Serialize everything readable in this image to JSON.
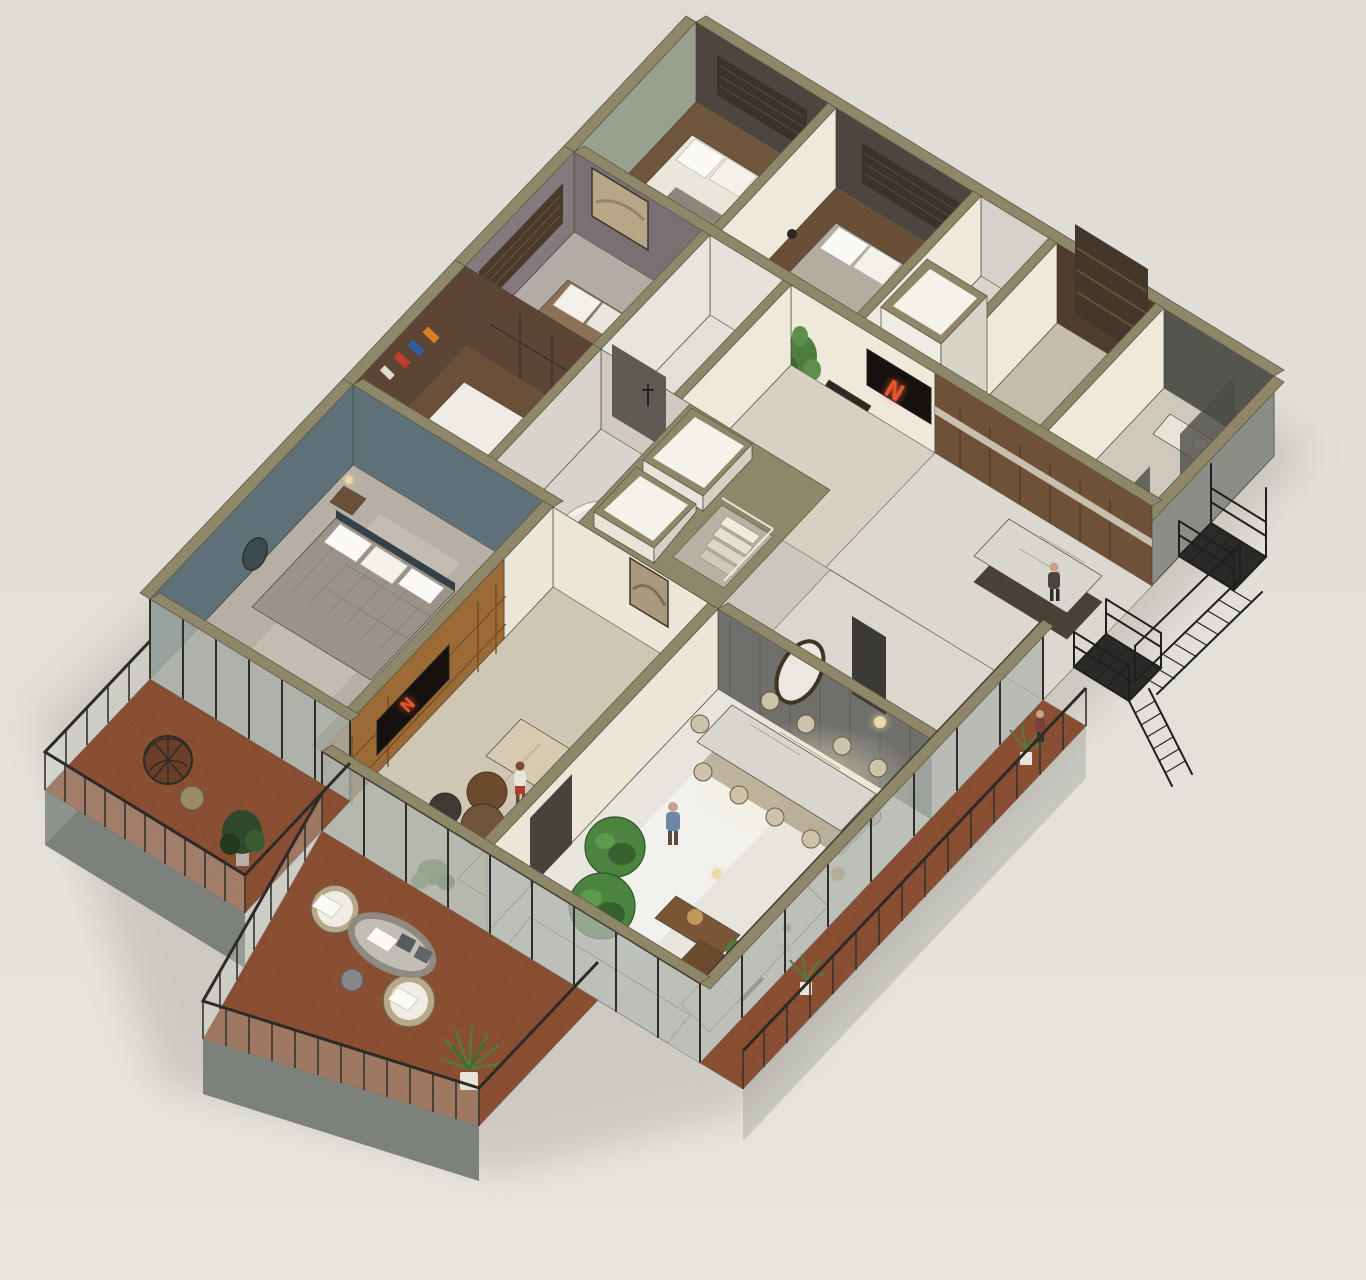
{
  "scene": {
    "type": "isometric-floorplan-3d-render",
    "description": "Cutaway axonometric render of a large apartment floor",
    "rooms": [
      "bedroom-corner",
      "bedroom-two",
      "guest-bathroom",
      "pantry",
      "laundry-room",
      "mauve-bedroom",
      "white-bathroom",
      "upper-hallway",
      "kitchen",
      "walk-in-closet",
      "master-bathroom",
      "stair-hall",
      "kitchen-corridor",
      "master-bedroom",
      "media-room",
      "dining-room",
      "living-room",
      "master-terrace",
      "main-terrace",
      "side-balcony",
      "fire-escape"
    ]
  },
  "logos": {
    "tv_n": "N",
    "media_n": "N"
  },
  "palette": {
    "bg": "#e3e0d9",
    "bgEdge": "#d9d6ce",
    "shadow": "#a8a196",
    "roofCap": "#8f8769",
    "wallCream": "#efe9dc",
    "wallDarkOlive": "#4c463e",
    "wallMauve": "#7a7073",
    "wallSage": "#9aa08e",
    "wallBlue": "#5e7078",
    "wallFeatureGray": "#6f706b",
    "closetWood": "#5c4534",
    "kitchenCabinet": "#6e5136",
    "mediaWallOrange": "#9c6a34",
    "exteriorGray": "#8b8e87",
    "glassTint": "#adb3ac",
    "floorWood": "#6f553c",
    "floorGloss": "#e8e5de",
    "terraceWood": "#8a4f33",
    "greenChair": "#4c8340",
    "sofaCream": "#e9e6de",
    "sofaBeige": "#d7cab0",
    "tableWood": "#7a5636",
    "marbleTop": "#d9d6cf",
    "screenBlack": "#14110e",
    "logoRed": "#e4572e",
    "brass": "#c8a05f",
    "plantGreen": "#4e7d3f",
    "fireEscape": "#1f1f1d"
  }
}
